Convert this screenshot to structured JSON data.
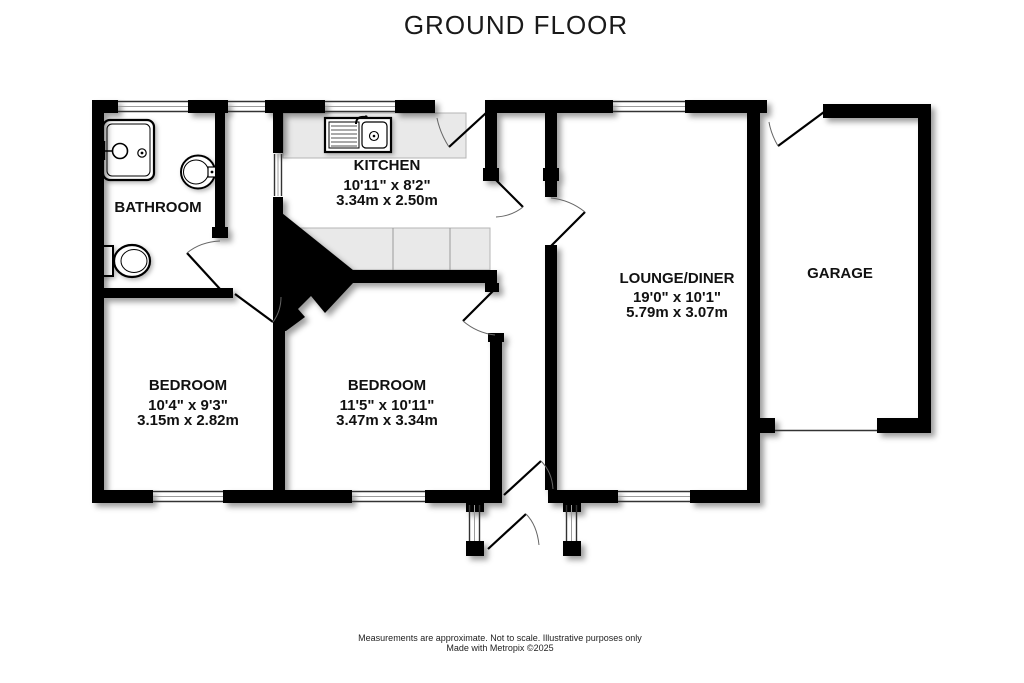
{
  "title": "GROUND FLOOR",
  "rooms": {
    "bathroom": {
      "name": "BATHROOM"
    },
    "kitchen": {
      "name": "KITCHEN",
      "dims_imperial": "10'11\" x 8'2\"",
      "dims_metric": "3.34m x 2.50m"
    },
    "lounge": {
      "name": "LOUNGE/DINER",
      "dims_imperial": "19'0\" x 10'1\"",
      "dims_metric": "5.79m x 3.07m"
    },
    "garage": {
      "name": "GARAGE"
    },
    "bedroom1": {
      "name": "BEDROOM",
      "dims_imperial": "10'4\" x 9'3\"",
      "dims_metric": "3.15m x 2.82m"
    },
    "bedroom2": {
      "name": "BEDROOM",
      "dims_imperial": "11'5\" x 10'11\"",
      "dims_metric": "3.47m x 3.34m"
    }
  },
  "footer": {
    "line1": "Measurements are approximate.  Not to scale.  Illustrative purposes only",
    "line2": "Made with Metropix ©2025"
  },
  "colors": {
    "wall": "#000000",
    "counter": "#e9e9e9",
    "background": "#ffffff"
  }
}
